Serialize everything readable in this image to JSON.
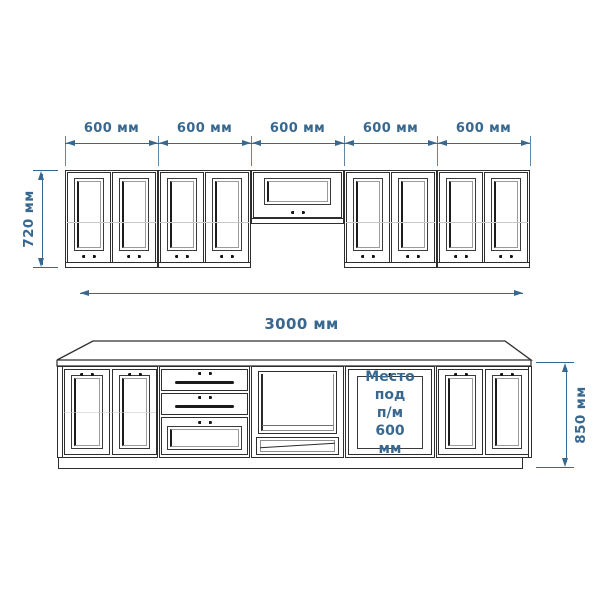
{
  "colors": {
    "background": "#ffffff",
    "line": "#2e2e2e",
    "dimension": "#38688f"
  },
  "dimensions": {
    "upper_segments": [
      "600 мм",
      "600 мм",
      "600 мм",
      "600 мм",
      "600 мм"
    ],
    "total_width": "3000 мм",
    "upper_height": "720 мм",
    "base_height": "850 мм"
  },
  "annotations": {
    "dishwasher_space": [
      "Место",
      "под",
      "п/м 600",
      "мм"
    ]
  }
}
